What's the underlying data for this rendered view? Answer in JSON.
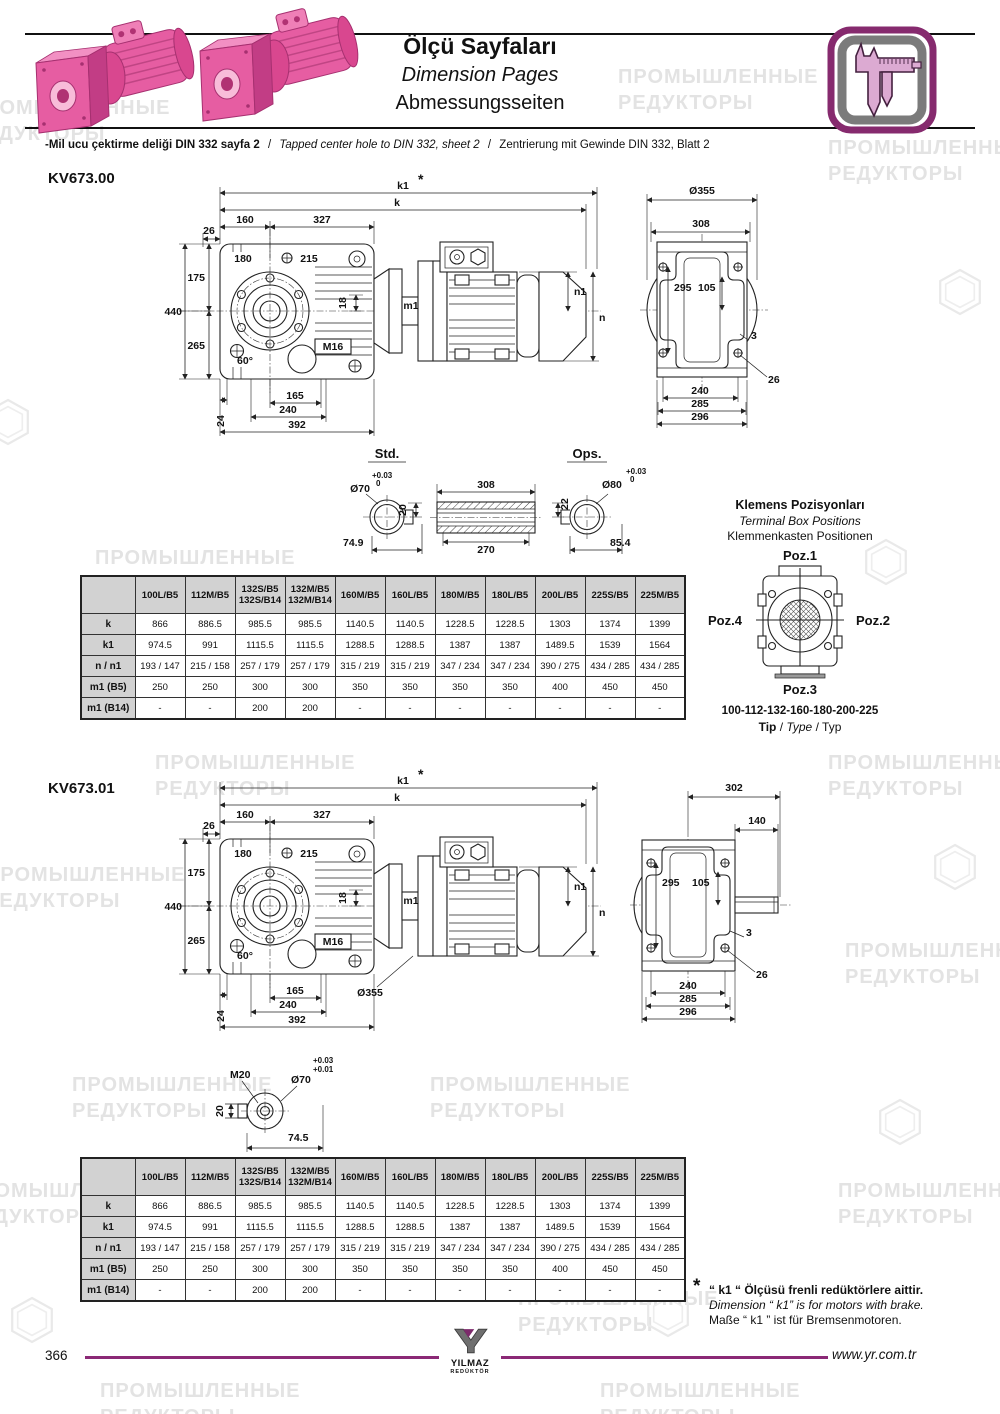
{
  "watermark": {
    "line1": "ПРОМЫШЛЕННЫЕ",
    "line2": "РЕДУКТОРЫ"
  },
  "header": {
    "title_tr": "Ölçü Sayfaları",
    "title_en": "Dimension Pages",
    "title_de": "Abmessungsseiten",
    "note_tr": "-Mil ucu çektirme deliği DIN 332 sayfa 2",
    "sep": "/",
    "note_en": "Tapped center hole to DIN 332, sheet 2",
    "note_de": "Zentrierung mit Gewinde DIN 332, Blatt 2"
  },
  "kv67300": {
    "heading": "KV673.00",
    "dims": {
      "k1": "k1",
      "star": "*",
      "k": "k",
      "d160": "160",
      "d327": "327",
      "d26": "26",
      "d180": "180",
      "d215": "215",
      "d175": "175",
      "d440": "440",
      "d265": "265",
      "d18": "18",
      "d60": "60°",
      "m16": "M16",
      "m1": "m1",
      "n1": "n1",
      "n": "n",
      "d24": "24",
      "d165": "165",
      "d240": "240",
      "d392": "392"
    },
    "rear": {
      "d355": "Ø355",
      "d308": "308",
      "d295": "295",
      "d105": "105",
      "d3": "3",
      "d26": "26",
      "d240": "240",
      "d285": "285",
      "d296": "296"
    }
  },
  "shafts": {
    "std_label": "Std.",
    "ops_label": "Ops.",
    "std_dia": "Ø70",
    "std_tol_hi": "+0.03",
    "std_tol_lo": "0",
    "std_key": "20",
    "std_len": "74.9",
    "hollow_len": "308",
    "hollow_inner": "270",
    "ops_dia": "Ø80",
    "ops_tol_hi": "+0.03",
    "ops_tol_lo": "0",
    "ops_key": "22",
    "ops_len": "85.4"
  },
  "terminal_box": {
    "title_tr": "Klemens Pozisyonları",
    "title_en": "Terminal Box Positions",
    "title_de": "Klemmenkasten Positionen",
    "poz1": "Poz.1",
    "poz2": "Poz.2",
    "poz3": "Poz.3",
    "poz4": "Poz.4",
    "sizes": "100-112-132-160-180-200-225",
    "tip_tr": "Tip",
    "sep": "/",
    "tip_en": "Type",
    "tip_de": "Typ"
  },
  "table_kv67300": {
    "headers": [
      "",
      "100L/B5",
      "112M/B5",
      "132S/B5\n132S/B14",
      "132M/B5\n132M/B14",
      "160M/B5",
      "160L/B5",
      "180M/B5",
      "180L/B5",
      "200L/B5",
      "225S/B5",
      "225M/B5"
    ],
    "rows": [
      {
        "label": "k",
        "values": [
          "866",
          "886.5",
          "985.5",
          "985.5",
          "1140.5",
          "1140.5",
          "1228.5",
          "1228.5",
          "1303",
          "1374",
          "1399"
        ]
      },
      {
        "label": "k1",
        "values": [
          "974.5",
          "991",
          "1115.5",
          "1115.5",
          "1288.5",
          "1288.5",
          "1387",
          "1387",
          "1489.5",
          "1539",
          "1564"
        ]
      },
      {
        "label": "n / n1",
        "values": [
          "193 / 147",
          "215 / 158",
          "257 / 179",
          "257 / 179",
          "315 / 219",
          "315 / 219",
          "347 / 234",
          "347 / 234",
          "390 / 275",
          "434 / 285",
          "434 / 285"
        ]
      },
      {
        "label": "m1 (B5)",
        "values": [
          "250",
          "250",
          "300",
          "300",
          "350",
          "350",
          "350",
          "350",
          "400",
          "450",
          "450"
        ]
      },
      {
        "label": "m1 (B14)",
        "values": [
          "-",
          "-",
          "200",
          "200",
          "-",
          "-",
          "-",
          "-",
          "-",
          "-",
          "-"
        ]
      }
    ]
  },
  "kv67301": {
    "heading": "KV673.01",
    "dims": {
      "k1": "k1",
      "star": "*",
      "k": "k",
      "d160": "160",
      "d327": "327",
      "d26": "26",
      "d180": "180",
      "d215": "215",
      "d175": "175",
      "d440": "440",
      "d265": "265",
      "d18": "18",
      "d60": "60°",
      "m16": "M16",
      "m1": "m1",
      "n1": "n1",
      "n": "n",
      "d24": "24",
      "d165": "165",
      "d240": "240",
      "d392": "392",
      "d355": "Ø355"
    },
    "rear": {
      "d302": "302",
      "d140": "140",
      "d295": "295",
      "d105": "105",
      "d3": "3",
      "d26": "26",
      "d240": "240",
      "d285": "285",
      "d296": "296"
    },
    "shaft": {
      "thread": "M20",
      "tol_hi": "+0.03",
      "tol_lo": "+0.01",
      "dia": "Ø70",
      "key": "20",
      "len": "74.5"
    }
  },
  "table_kv67301": {
    "headers": [
      "",
      "100L/B5",
      "112M/B5",
      "132S/B5\n132S/B14",
      "132M/B5\n132M/B14",
      "160M/B5",
      "160L/B5",
      "180M/B5",
      "180L/B5",
      "200L/B5",
      "225S/B5",
      "225M/B5"
    ],
    "rows": [
      {
        "label": "k",
        "values": [
          "866",
          "886.5",
          "985.5",
          "985.5",
          "1140.5",
          "1140.5",
          "1228.5",
          "1228.5",
          "1303",
          "1374",
          "1399"
        ]
      },
      {
        "label": "k1",
        "values": [
          "974.5",
          "991",
          "1115.5",
          "1115.5",
          "1288.5",
          "1288.5",
          "1387",
          "1387",
          "1489.5",
          "1539",
          "1564"
        ]
      },
      {
        "label": "n / n1",
        "values": [
          "193 / 147",
          "215 / 158",
          "257 / 179",
          "257 / 179",
          "315 / 219",
          "315 / 219",
          "347 / 234",
          "347 / 234",
          "390 / 275",
          "434 / 285",
          "434 / 285"
        ]
      },
      {
        "label": "m1 (B5)",
        "values": [
          "250",
          "250",
          "300",
          "300",
          "350",
          "350",
          "350",
          "350",
          "400",
          "450",
          "450"
        ]
      },
      {
        "label": "m1 (B14)",
        "values": [
          "-",
          "-",
          "200",
          "200",
          "-",
          "-",
          "-",
          "-",
          "-",
          "-",
          "-"
        ]
      }
    ]
  },
  "footnote": {
    "star": "*",
    "tr": "“ k1 “ Ölçüsü frenli redüktörlere aittir.",
    "en": "Dimension “ k1” is for motors with brake.",
    "de": "Maße “ k1 ” ist für Bremsenmotoren."
  },
  "footer": {
    "page": "366",
    "url": "www.yr.com.tr",
    "logo_name": "YILMAZ",
    "logo_sub": "REDÜKTÖR"
  }
}
